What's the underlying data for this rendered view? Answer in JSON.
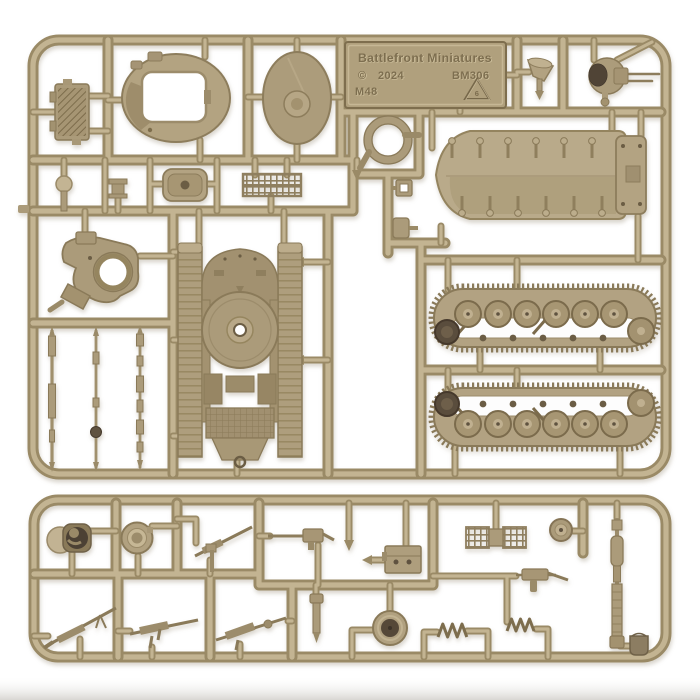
{
  "photo": {
    "type": "product photograph",
    "subject": "tan injection-molded plastic model sprue with M48 tank parts on white background"
  },
  "plate": {
    "brand": "Battlefront Miniatures",
    "copyright_symbol": "©",
    "year": "2024",
    "product_code": "BM306",
    "model_code": "M48",
    "recycling_number": "6"
  },
  "colors": {
    "sprue_core": "#c3b492",
    "sprue_edge": "#9a8a66",
    "part_base": "#ab9b7a",
    "part_shadow": "#8a7a59",
    "part_dark": "#554838",
    "background": "#ffffff",
    "bottom_fade": "#d8d6d2"
  },
  "sprues": [
    {
      "name": "main sprue",
      "parts": [
        "engine-grille",
        "turret-shell",
        "turret-base-disc",
        "brand-plate",
        "searchlight",
        "commander-cupola",
        "sealing-ring",
        "periscope",
        "bracket",
        "hatch-cover",
        "stowage-mesh-rack",
        "retaining-clips",
        "hull-casting",
        "gun-mantlet",
        "gun-barrel-rods",
        "hull-bottom-turret-ring",
        "track-run-upper",
        "track-run-lower"
      ]
    },
    {
      "name": "accessory sprue",
      "parts": [
        "crew-figure-hatch",
        "open-hatch-ring",
        "pintle-mg",
        "machine-gun",
        "ammo-box",
        "stowage-basket",
        "road-wheel",
        "long-gun-barrel",
        "submachine-gun",
        "hatch-wheel",
        "spring-coil",
        "spring-coil-2",
        "tool",
        "mg-50cal",
        "mg-bar",
        "mg-lmg",
        "bucket"
      ]
    }
  ]
}
